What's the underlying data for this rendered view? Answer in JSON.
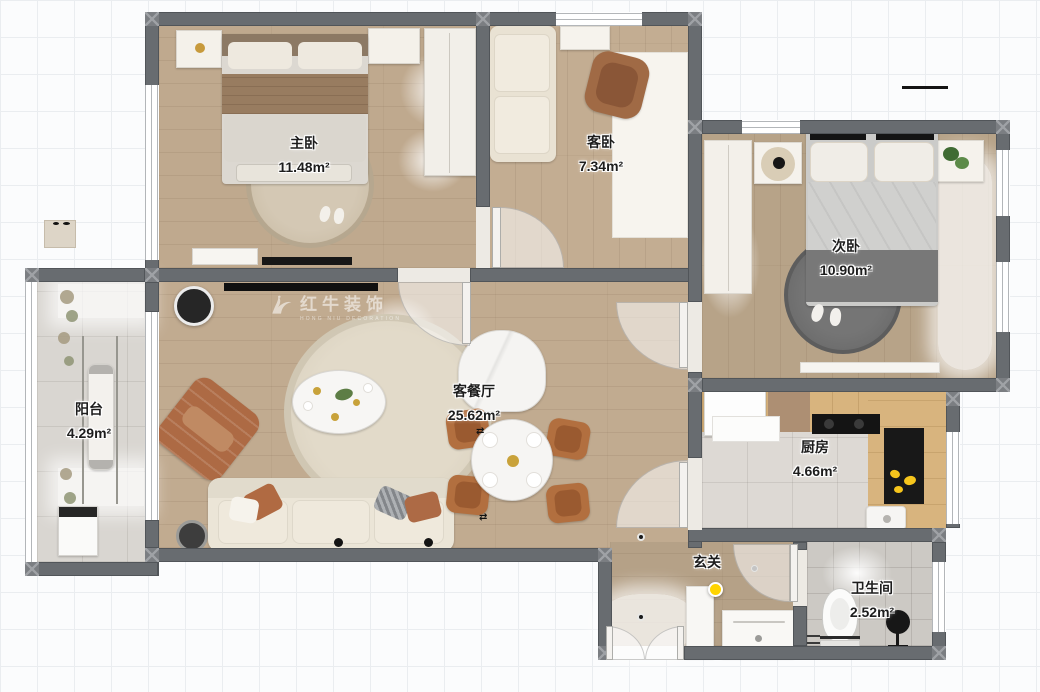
{
  "watermark": {
    "brand": "红牛装饰",
    "subtext": "HONG NIU DECORATION"
  },
  "rooms": [
    {
      "key": "master-bedroom",
      "name": "主卧",
      "area": "11.48m²"
    },
    {
      "key": "guest-bedroom",
      "name": "客卧",
      "area": "7.34m²"
    },
    {
      "key": "second-bedroom",
      "name": "次卧",
      "area": "10.90m²"
    },
    {
      "key": "balcony",
      "name": "阳台",
      "area": "4.29m²"
    },
    {
      "key": "living-dining",
      "name": "客餐厅",
      "area": "25.62m²"
    },
    {
      "key": "kitchen",
      "name": "厨房",
      "area": "4.66m²"
    },
    {
      "key": "hallway",
      "name": "玄关",
      "area": ""
    },
    {
      "key": "bathroom",
      "name": "卫生间",
      "area": "2.52m²"
    }
  ],
  "decor": {
    "move_arrows": "⇄"
  },
  "colors": {
    "wall": "#686c70",
    "wood_floor": "#c1ab90",
    "tile_floor": "#d9d6d1",
    "accent_terracotta": "#ad6a44",
    "marker_yellow": "#ffd400"
  }
}
